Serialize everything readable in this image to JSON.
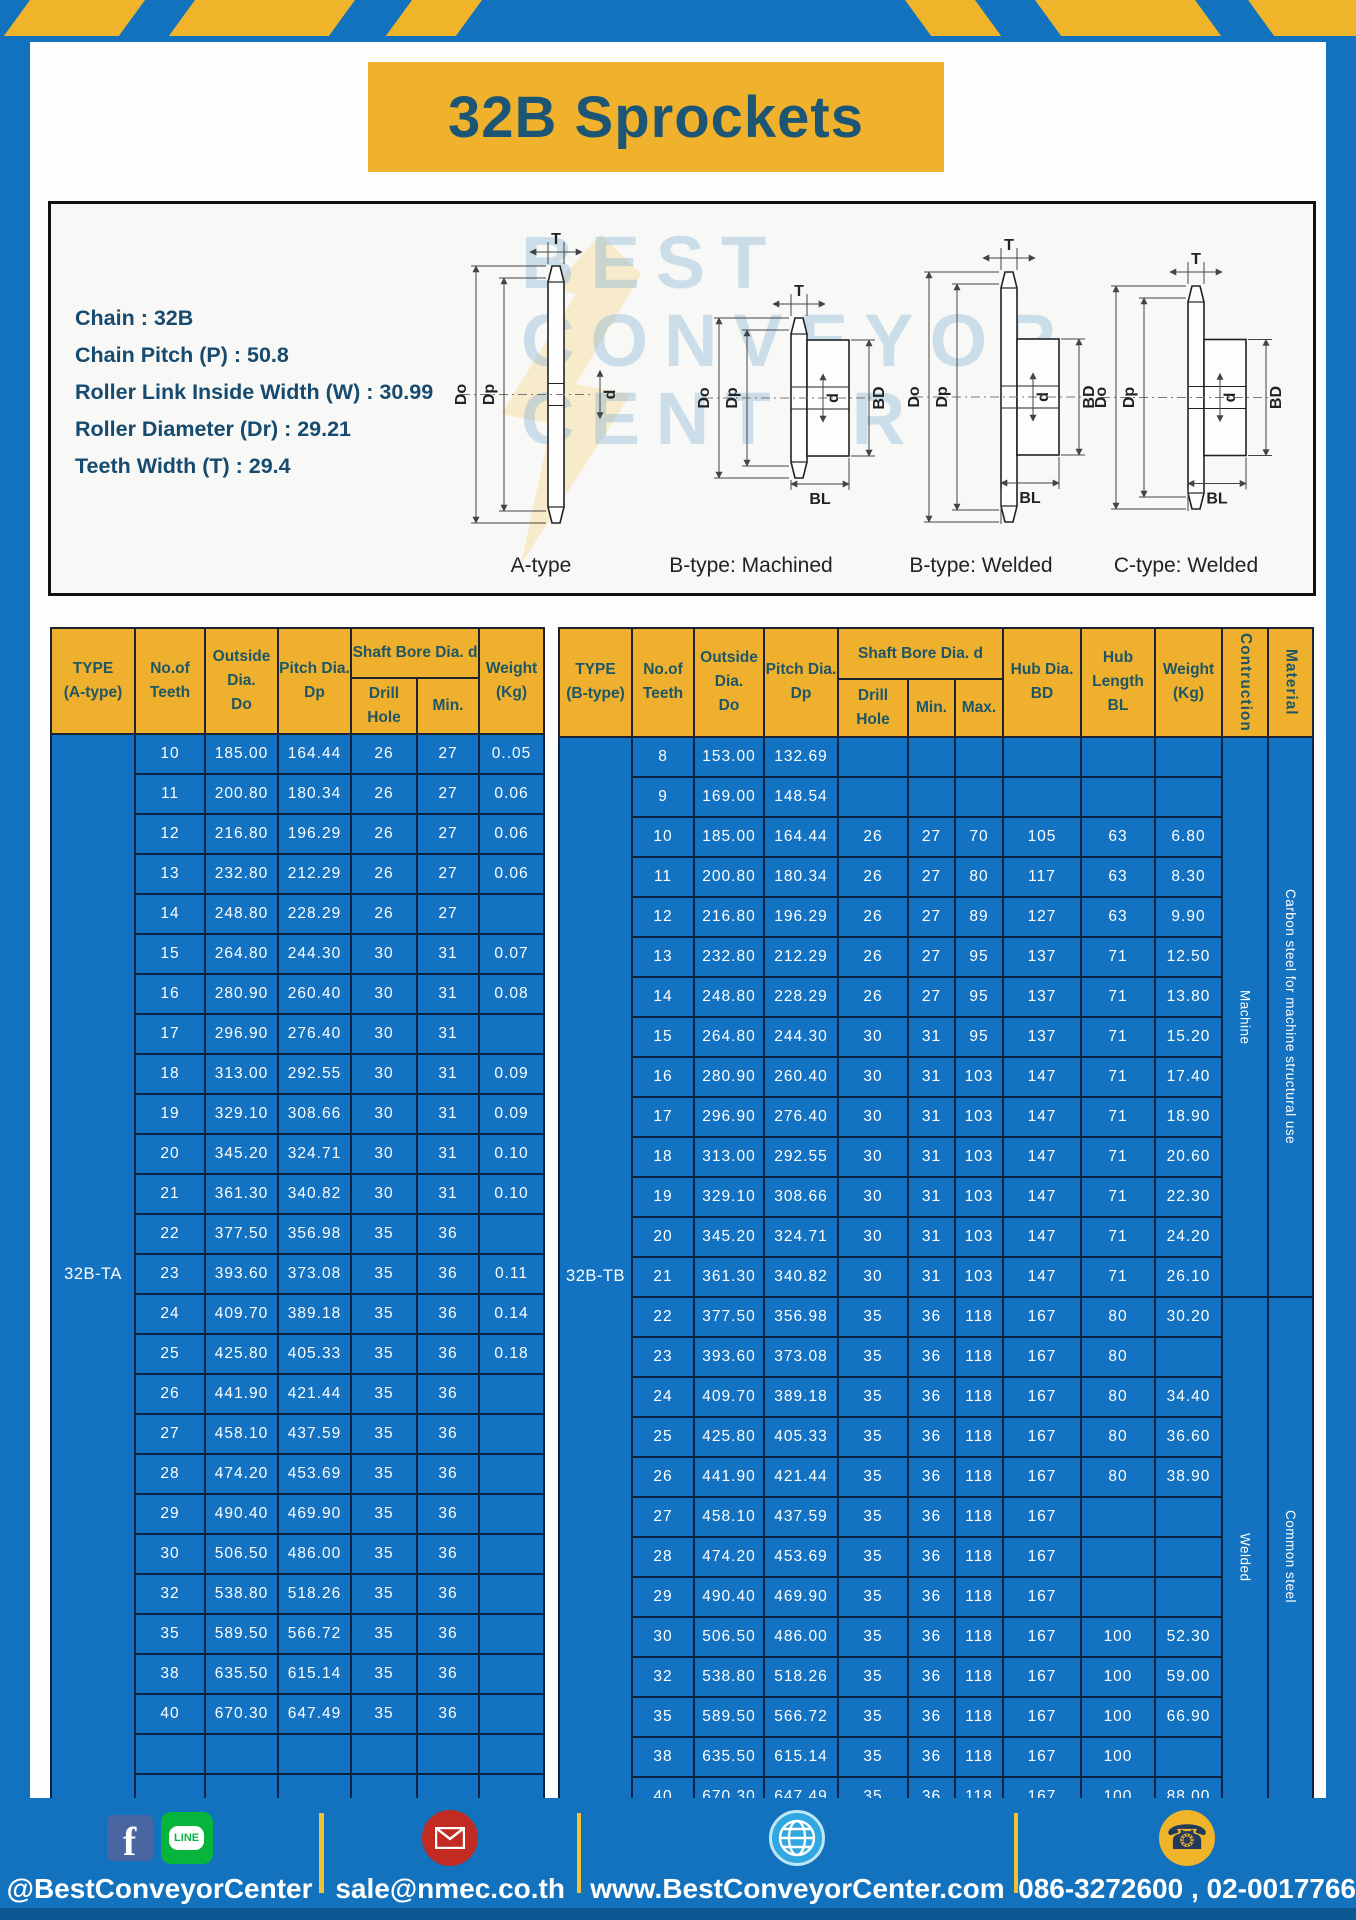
{
  "colors": {
    "frame_blue": "#1272bd",
    "accent_yellow": "#f0b12c",
    "table_body_blue": "#1373c2",
    "header_text": "#1e5666",
    "cell_border": "#0c2444"
  },
  "header": {
    "title": "32B Sprockets"
  },
  "specs": {
    "lines": [
      "Chain : 32B",
      "Chain Pitch (P) : 50.8",
      "Roller Link Inside Width (W) : 30.99",
      "Roller Diameter (Dr) : 29.21",
      "Teeth Width (T) : 29.4"
    ]
  },
  "diagram": {
    "variant_labels": [
      "A-type",
      "B-type: Machined",
      "B-type: Welded",
      "C-type: Welded"
    ],
    "dims": {
      "t": "T",
      "do": "Do",
      "dp": "Dp",
      "d": "d",
      "bd": "BD",
      "bl": "BL"
    },
    "watermark": [
      "BEST",
      "CONVEYOR",
      "CENTER"
    ]
  },
  "table_a": {
    "type_label": "32B-TA",
    "headers": {
      "type": "TYPE\n(A-type)",
      "teeth": "No.of\nTeeth",
      "outside": "Outside\nDia.\nDo",
      "pitch": "Pitch Dia.\nDp",
      "shaft": "Shaft Bore Dia. d",
      "drill": "Drill Hole",
      "min": "Min.",
      "weight": "Weight\n(Kg)"
    },
    "rows": [
      [
        "10",
        "185.00",
        "164.44",
        "26",
        "27",
        "0..05"
      ],
      [
        "11",
        "200.80",
        "180.34",
        "26",
        "27",
        "0.06"
      ],
      [
        "12",
        "216.80",
        "196.29",
        "26",
        "27",
        "0.06"
      ],
      [
        "13",
        "232.80",
        "212.29",
        "26",
        "27",
        "0.06"
      ],
      [
        "14",
        "248.80",
        "228.29",
        "26",
        "27",
        ""
      ],
      [
        "15",
        "264.80",
        "244.30",
        "30",
        "31",
        "0.07"
      ],
      [
        "16",
        "280.90",
        "260.40",
        "30",
        "31",
        "0.08"
      ],
      [
        "17",
        "296.90",
        "276.40",
        "30",
        "31",
        ""
      ],
      [
        "18",
        "313.00",
        "292.55",
        "30",
        "31",
        "0.09"
      ],
      [
        "19",
        "329.10",
        "308.66",
        "30",
        "31",
        "0.09"
      ],
      [
        "20",
        "345.20",
        "324.71",
        "30",
        "31",
        "0.10"
      ],
      [
        "21",
        "361.30",
        "340.82",
        "30",
        "31",
        "0.10"
      ],
      [
        "22",
        "377.50",
        "356.98",
        "35",
        "36",
        ""
      ],
      [
        "23",
        "393.60",
        "373.08",
        "35",
        "36",
        "0.11"
      ],
      [
        "24",
        "409.70",
        "389.18",
        "35",
        "36",
        "0.14"
      ],
      [
        "25",
        "425.80",
        "405.33",
        "35",
        "36",
        "0.18"
      ],
      [
        "26",
        "441.90",
        "421.44",
        "35",
        "36",
        ""
      ],
      [
        "27",
        "458.10",
        "437.59",
        "35",
        "36",
        ""
      ],
      [
        "28",
        "474.20",
        "453.69",
        "35",
        "36",
        ""
      ],
      [
        "29",
        "490.40",
        "469.90",
        "35",
        "36",
        ""
      ],
      [
        "30",
        "506.50",
        "486.00",
        "35",
        "36",
        ""
      ],
      [
        "32",
        "538.80",
        "518.26",
        "35",
        "36",
        ""
      ],
      [
        "35",
        "589.50",
        "566.72",
        "35",
        "36",
        ""
      ],
      [
        "38",
        "635.50",
        "615.14",
        "35",
        "36",
        ""
      ],
      [
        "40",
        "670.30",
        "647.49",
        "35",
        "36",
        ""
      ],
      [
        "",
        "",
        "",
        "",
        "",
        ""
      ],
      [
        "",
        "",
        "",
        "",
        "",
        ""
      ]
    ]
  },
  "table_b": {
    "type_label": "32B-TB",
    "headers": {
      "type": "TYPE\n(B-type)",
      "teeth": "No.of\nTeeth",
      "outside": "Outside\nDia.\nDo",
      "pitch": "Pitch Dia.\nDp",
      "shaft": "Shaft Bore Dia. d",
      "drill": "Drill Hole",
      "min": "Min.",
      "max": "Max.",
      "hub_dia": "Hub Dia.\nBD",
      "hub_len": "Hub\nLength\nBL",
      "weight": "Weight\n(Kg)",
      "construction": "Contruction",
      "material": "Material"
    },
    "rows": [
      [
        "8",
        "153.00",
        "132.69",
        "",
        "",
        "",
        "",
        "",
        ""
      ],
      [
        "9",
        "169.00",
        "148.54",
        "",
        "",
        "",
        "",
        "",
        ""
      ],
      [
        "10",
        "185.00",
        "164.44",
        "26",
        "27",
        "70",
        "105",
        "63",
        "6.80"
      ],
      [
        "11",
        "200.80",
        "180.34",
        "26",
        "27",
        "80",
        "117",
        "63",
        "8.30"
      ],
      [
        "12",
        "216.80",
        "196.29",
        "26",
        "27",
        "89",
        "127",
        "63",
        "9.90"
      ],
      [
        "13",
        "232.80",
        "212.29",
        "26",
        "27",
        "95",
        "137",
        "71",
        "12.50"
      ],
      [
        "14",
        "248.80",
        "228.29",
        "26",
        "27",
        "95",
        "137",
        "71",
        "13.80"
      ],
      [
        "15",
        "264.80",
        "244.30",
        "30",
        "31",
        "95",
        "137",
        "71",
        "15.20"
      ],
      [
        "16",
        "280.90",
        "260.40",
        "30",
        "31",
        "103",
        "147",
        "71",
        "17.40"
      ],
      [
        "17",
        "296.90",
        "276.40",
        "30",
        "31",
        "103",
        "147",
        "71",
        "18.90"
      ],
      [
        "18",
        "313.00",
        "292.55",
        "30",
        "31",
        "103",
        "147",
        "71",
        "20.60"
      ],
      [
        "19",
        "329.10",
        "308.66",
        "30",
        "31",
        "103",
        "147",
        "71",
        "22.30"
      ],
      [
        "20",
        "345.20",
        "324.71",
        "30",
        "31",
        "103",
        "147",
        "71",
        "24.20"
      ],
      [
        "21",
        "361.30",
        "340.82",
        "30",
        "31",
        "103",
        "147",
        "71",
        "26.10"
      ],
      [
        "22",
        "377.50",
        "356.98",
        "35",
        "36",
        "118",
        "167",
        "80",
        "30.20"
      ],
      [
        "23",
        "393.60",
        "373.08",
        "35",
        "36",
        "118",
        "167",
        "80",
        ""
      ],
      [
        "24",
        "409.70",
        "389.18",
        "35",
        "36",
        "118",
        "167",
        "80",
        "34.40"
      ],
      [
        "25",
        "425.80",
        "405.33",
        "35",
        "36",
        "118",
        "167",
        "80",
        "36.60"
      ],
      [
        "26",
        "441.90",
        "421.44",
        "35",
        "36",
        "118",
        "167",
        "80",
        "38.90"
      ],
      [
        "27",
        "458.10",
        "437.59",
        "35",
        "36",
        "118",
        "167",
        "",
        ""
      ],
      [
        "28",
        "474.20",
        "453.69",
        "35",
        "36",
        "118",
        "167",
        "",
        ""
      ],
      [
        "29",
        "490.40",
        "469.90",
        "35",
        "36",
        "118",
        "167",
        "",
        ""
      ],
      [
        "30",
        "506.50",
        "486.00",
        "35",
        "36",
        "118",
        "167",
        "100",
        "52.30"
      ],
      [
        "32",
        "538.80",
        "518.26",
        "35",
        "36",
        "118",
        "167",
        "100",
        "59.00"
      ],
      [
        "35",
        "589.50",
        "566.72",
        "35",
        "36",
        "118",
        "167",
        "100",
        "66.90"
      ],
      [
        "38",
        "635.50",
        "615.14",
        "35",
        "36",
        "118",
        "167",
        "100",
        ""
      ],
      [
        "40",
        "670.30",
        "647.49",
        "35",
        "36",
        "118",
        "167",
        "100",
        "88.00"
      ]
    ],
    "span_columns": [
      [
        {
          "text": "Machine",
          "start": 0,
          "count": 14
        },
        {
          "text": "Welded",
          "start": 14,
          "count": 13
        }
      ],
      [
        {
          "text": "Carbon steel for machine structural use",
          "start": 0,
          "count": 14
        },
        {
          "text": "Common steel",
          "start": 14,
          "count": 13
        }
      ]
    ]
  },
  "footer": {
    "facebook_f": "f",
    "line_text": "LINE",
    "social_label": "@BestConveyorCenter",
    "email": "sale@nmec.co.th",
    "website": "www.BestConveyorCenter.com",
    "phones": "086-3272600 , 02-0017766"
  }
}
